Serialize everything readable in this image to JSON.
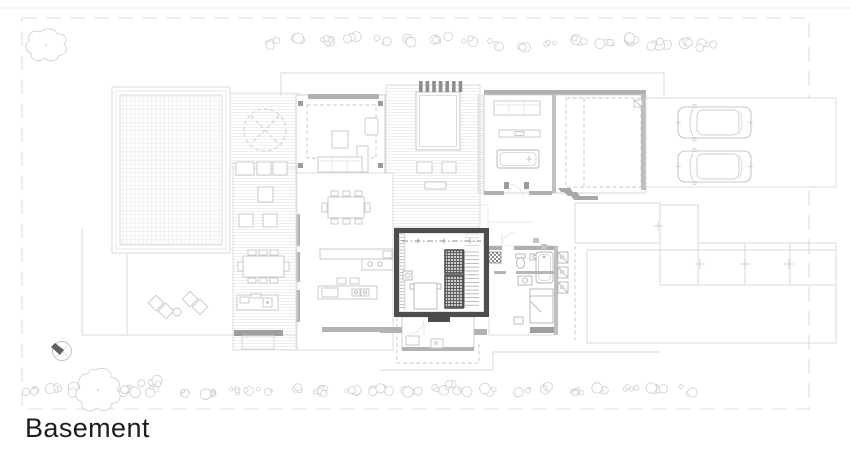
{
  "title": {
    "label": "Basement"
  },
  "plan": {
    "floor_label": "Basement",
    "highlighted_area": "basement core with staircase and shaft",
    "visible_elements": {
      "cars": 2,
      "north_arrow": 1,
      "pool": 1,
      "parasol_terrace": 1
    },
    "colors": {
      "background": "#ffffff",
      "line_light": "#d8d8d8",
      "line_medium": "#b0b0b0",
      "wall_dark": "#4d4d4d",
      "boundary": "#dcdcdc",
      "text": "#1d1d1d"
    }
  }
}
